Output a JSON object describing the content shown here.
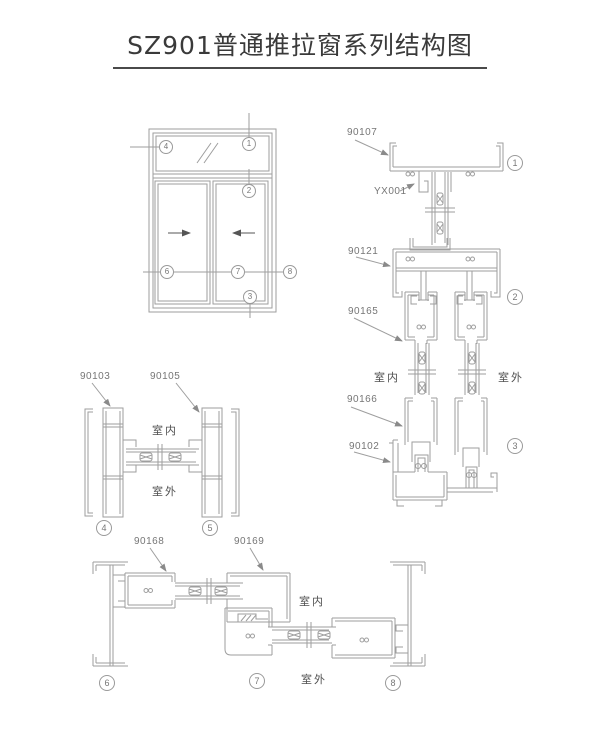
{
  "title": "SZ901普通推拉窗系列结构图",
  "orientation": {
    "indoor": "室内",
    "outdoor": "室外"
  },
  "parts": {
    "frame_top": "90107",
    "glazing_bead": "YX001",
    "head_track": "90121",
    "sash_top": "90165",
    "sash_bottom": "90166",
    "sill_track": "90102",
    "jamb_left": "90103",
    "jamb_right": "90105",
    "sash_stile": "90168",
    "meeting_stile": "90169"
  },
  "callouts": {
    "n1": "1",
    "n2": "2",
    "n3": "3",
    "n4": "4",
    "n5": "5",
    "n6": "6",
    "n7": "7",
    "n8": "8"
  },
  "colors": {
    "line": "#9e9e9e",
    "label": "#767676",
    "title": "#3a3a3a",
    "underline": "#4a4a4a"
  }
}
